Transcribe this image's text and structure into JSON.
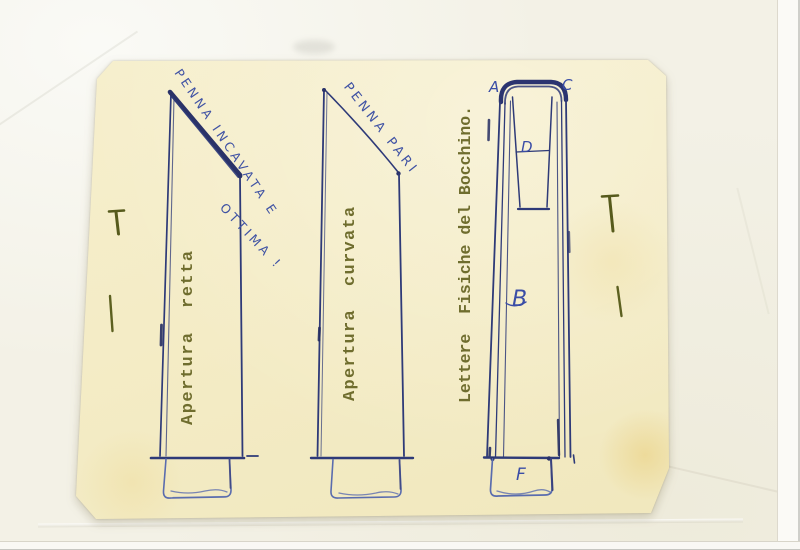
{
  "drawings": {
    "left": {
      "handwritten_note_line1": "PENNA INCAVATA E",
      "handwritten_note_line2": "OTTIMA !",
      "caption": "Apertura  retta"
    },
    "middle": {
      "handwritten_note": "PENNA PARI",
      "caption": "Apertura  curvata"
    },
    "right": {
      "caption": "Lettere  Fisiche del Bocchino.",
      "letters": {
        "a": "A",
        "c": "C",
        "d": "D",
        "b": "B",
        "f": "F"
      }
    }
  },
  "colors": {
    "ink_dark": "#2e3a78",
    "ink_light": "#5a6cae",
    "handwriting_blue": "#4053a4",
    "typewriter_olive": "#6f6d2e",
    "cream_paper": "#f4ecc6",
    "backing_paper": "#f3f1e6",
    "pin_green": "#565a1c"
  }
}
